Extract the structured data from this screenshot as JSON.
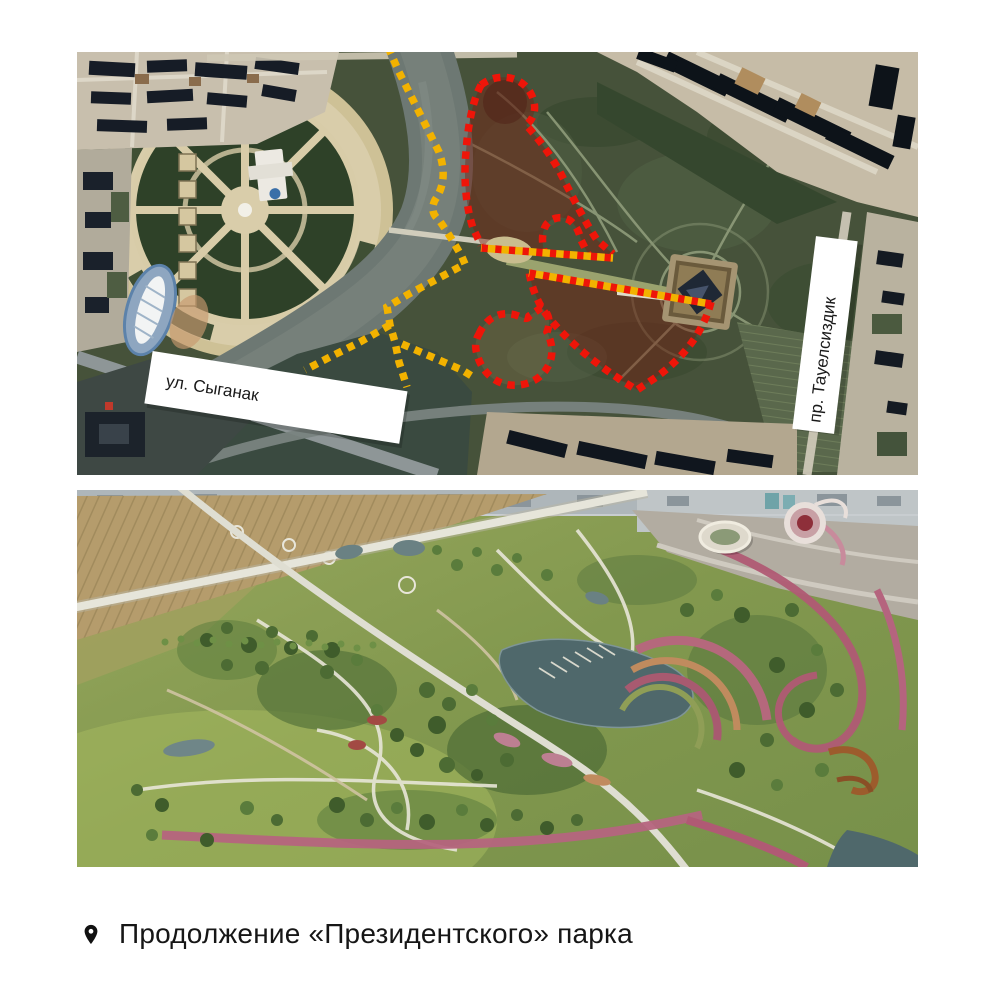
{
  "page": {
    "background_color": "#ffffff"
  },
  "top_map": {
    "description": "satellite map of the Presidential park area with marked boundaries",
    "street_labels": [
      {
        "id": "syganak",
        "text": "ул. Сыганак"
      },
      {
        "id": "tauelsizdik",
        "text": "пр. Тауелсиздик"
      }
    ],
    "overlays": {
      "existing_boundary_color": "#f2b200",
      "extension_boundary_color": "#ee1509",
      "extension_fill_color": "#7a1f12"
    }
  },
  "bottom_render": {
    "description": "aerial render of the planned park extension"
  },
  "caption": {
    "icon": "location-pin",
    "text": "Продолжение «Президентского» парка",
    "text_color": "#161616"
  }
}
